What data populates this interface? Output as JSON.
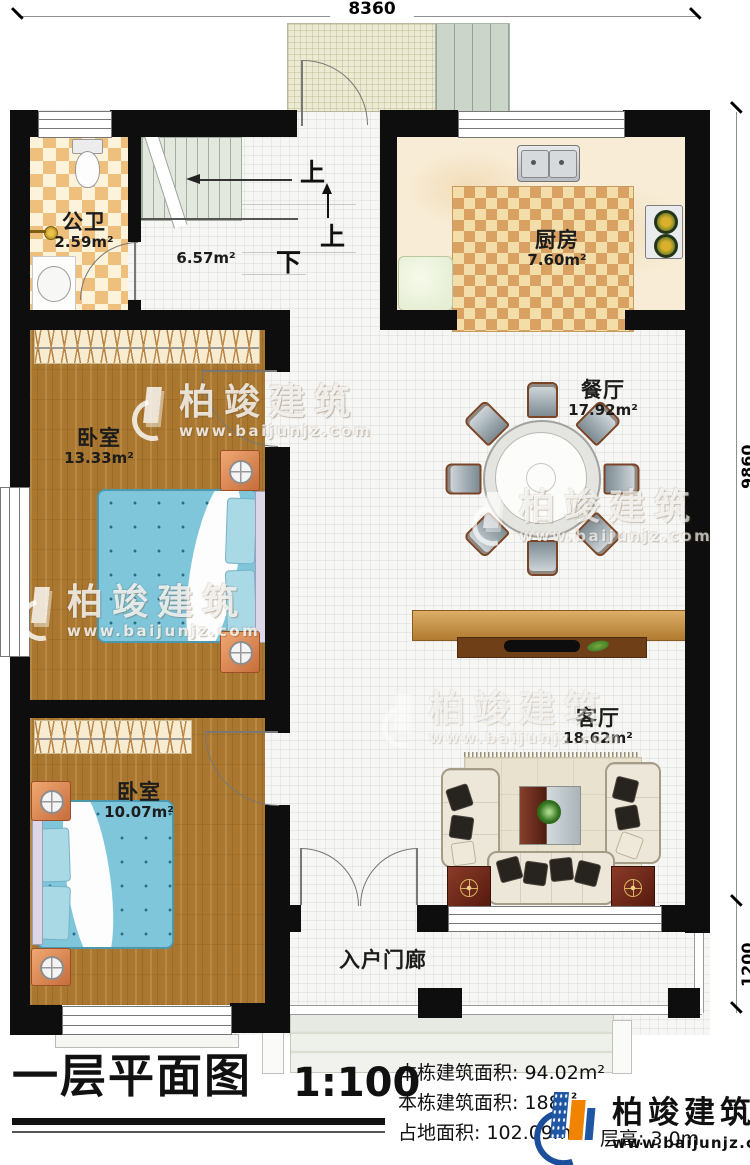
{
  "dimensions": {
    "top": "8360",
    "right": "9860",
    "porch_depth": "1200"
  },
  "rooms": {
    "bathroom": {
      "name": "公卫",
      "area": "2.59m²"
    },
    "stair_hall": {
      "area": "6.57m²"
    },
    "kitchen": {
      "name": "厨房",
      "area": "7.60m²"
    },
    "dining": {
      "name": "餐厅",
      "area": "17.92m²"
    },
    "bedroom_top": {
      "name": "卧室",
      "area": "13.33m²"
    },
    "bedroom_bottom": {
      "name": "卧室",
      "area": "10.07m²"
    },
    "living": {
      "name": "客厅",
      "area": "18.62m²"
    },
    "porch": {
      "name": "入户门廊"
    }
  },
  "stairs": {
    "up_label_a": "上",
    "up_label_b": "上",
    "down_label": "下"
  },
  "watermark": {
    "brand": "柏竣建筑",
    "url": "www.baijunjz.com"
  },
  "titleblock": {
    "title": "一层平面图",
    "scale": "1:100",
    "info_lines": [
      "本栋建筑面积: 94.02m²",
      "本栋建筑面积: 188.",
      "占地面积: 102.09m²",
      "层高: 3.0m"
    ],
    "sup2": "²",
    "logo_brand": "柏竣建筑",
    "logo_url": "www.baijunjz.com"
  },
  "colors": {
    "wall": "#0e0e0e",
    "accent_orange": "#f08300",
    "accent_blue": "#1b4f9c"
  }
}
